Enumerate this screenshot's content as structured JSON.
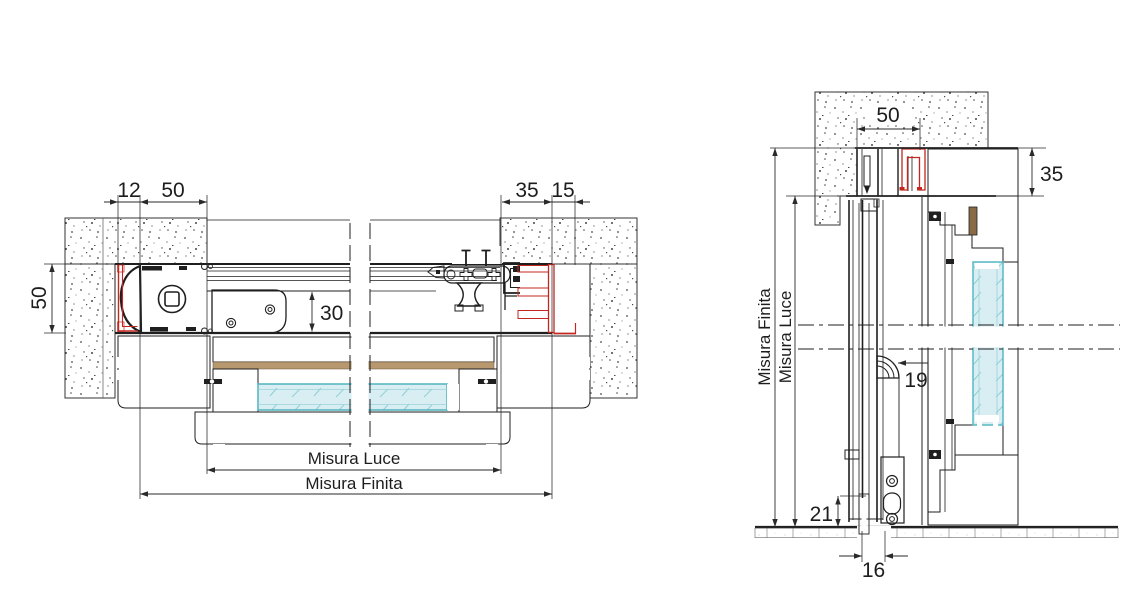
{
  "drawing": {
    "kind": "technical-section-drawing",
    "views": [
      "horizontal-section",
      "vertical-section"
    ]
  },
  "left_view": {
    "dims": {
      "offset": "12",
      "box_depth": "50",
      "jamb": "35",
      "reveal": "15",
      "frame_depth": "50",
      "cavity": "30",
      "clear_opening": "Misura Luce",
      "overall": "Misura Finita"
    }
  },
  "right_view": {
    "dims": {
      "track_width": "50",
      "head_height": "35",
      "roller_offset": "19",
      "bottom_gap": "21",
      "floor_channel": "16",
      "overall": "Misura Finita",
      "clear_opening": "Misura Luce"
    }
  },
  "colors": {
    "line_dark": "#1f1f1f",
    "accent_red": "#c4271f",
    "glass_stroke": "#58b8c3",
    "glass_fill": "#d9eef3",
    "wood_line": "#a07a4e",
    "concrete_dot": "#484848"
  }
}
